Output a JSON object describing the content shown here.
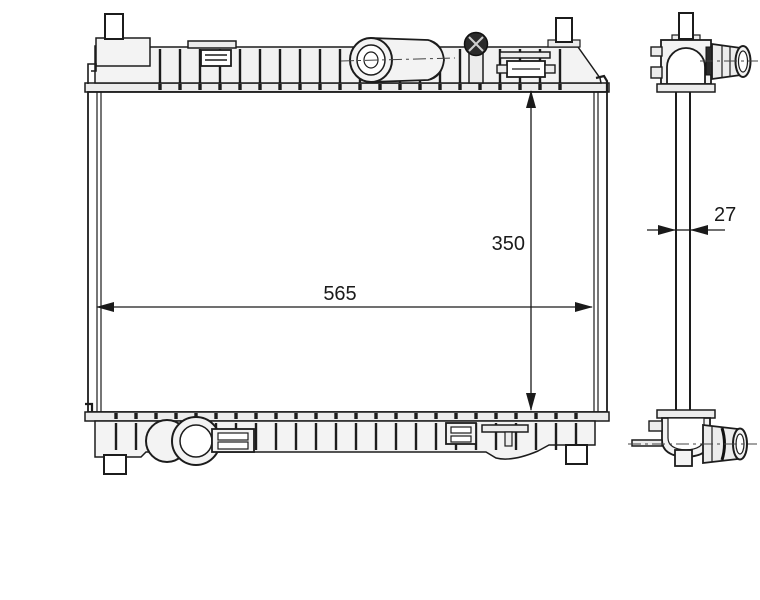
{
  "diagram": {
    "kind": "technical line drawing",
    "subject": "automotive radiator, front view and side profile with dimension callouts",
    "dimensions": {
      "width": "565",
      "core_height": "350",
      "depth": "27"
    },
    "colors": {
      "line": "#1c1c1c",
      "fill_light": "#f3f3f3",
      "background": "#ffffff",
      "label_text": "#1a1a1a"
    }
  }
}
